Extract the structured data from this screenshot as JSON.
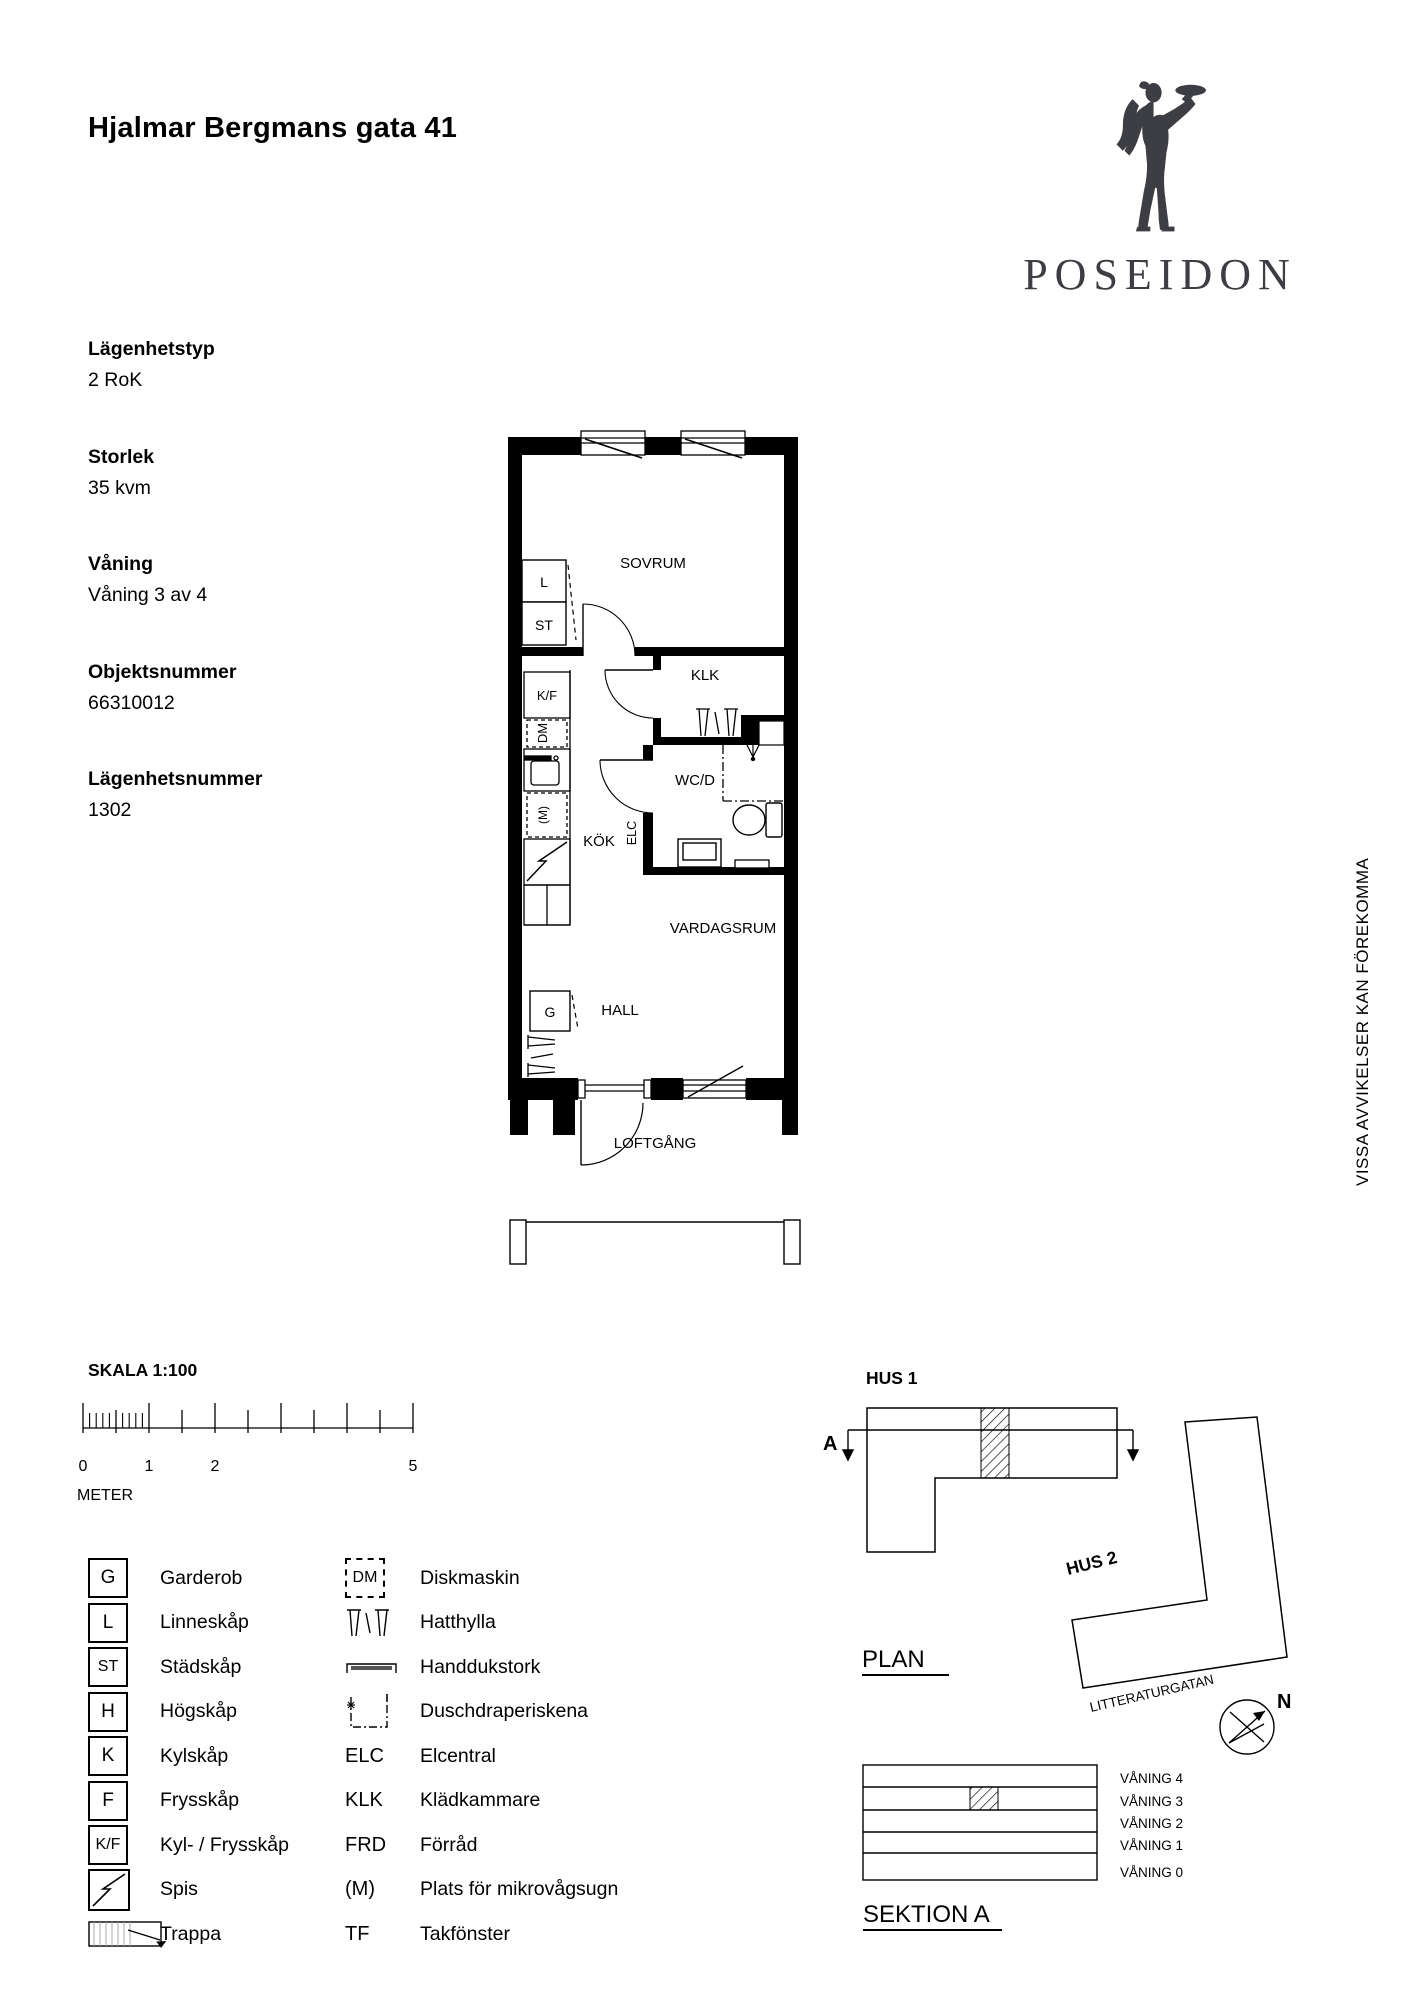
{
  "header": {
    "title": "Hjalmar Bergmans gata 41"
  },
  "logo": {
    "brand": "POSEIDON"
  },
  "info": {
    "fields": [
      {
        "label": "Lägenhetstyp",
        "value": "2 RoK"
      },
      {
        "label": "Storlek",
        "value": "35 kvm"
      },
      {
        "label": "Våning",
        "value": "Våning 3 av 4"
      },
      {
        "label": "Objektsnummer",
        "value": "66310012"
      },
      {
        "label": "Lägenhetsnummer",
        "value": "1302"
      }
    ]
  },
  "floorplan": {
    "rooms": {
      "sovrum": "SOVRUM",
      "klk": "KLK",
      "wcd": "WC/D",
      "kok": "KÖK",
      "vardagsrum": "VARDAGSRUM",
      "hall": "HALL",
      "loftgang": "LOFTGÅNG"
    },
    "markers": {
      "l": "L",
      "st": "ST",
      "kf": "K/F",
      "dm": "DM",
      "m": "(M)",
      "elc": "ELC",
      "g": "G"
    }
  },
  "disclaimer": "VISSA AVVIKELSER KAN FÖREKOMMA",
  "scalebar": {
    "title": "SKALA 1:100",
    "unit": "METER",
    "ticks": [
      "0",
      "1",
      "2",
      "5"
    ]
  },
  "legend": {
    "left": [
      {
        "code": "G",
        "label": "Garderob"
      },
      {
        "code": "L",
        "label": "Linneskåp"
      },
      {
        "code": "ST",
        "label": "Städskåp"
      },
      {
        "code": "H",
        "label": "Högskåp"
      },
      {
        "code": "K",
        "label": "Kylskåp"
      },
      {
        "code": "F",
        "label": "Frysskåp"
      },
      {
        "code": "K/F",
        "label": "Kyl- / Frysskåp"
      },
      {
        "code": "",
        "label": "Spis"
      },
      {
        "code": "",
        "label": "Trappa"
      }
    ],
    "right": [
      {
        "code": "DM",
        "label": "Diskmaskin"
      },
      {
        "code": "",
        "label": "Hatthylla"
      },
      {
        "code": "",
        "label": "Handdukstork"
      },
      {
        "code": "",
        "label": "Duschdraperiskena"
      },
      {
        "code": "ELC",
        "label": "Elcentral"
      },
      {
        "code": "KLK",
        "label": "Klädkammare"
      },
      {
        "code": "FRD",
        "label": "Förråd"
      },
      {
        "code": "(M)",
        "label": "Plats för mikrovågsugn"
      },
      {
        "code": "TF",
        "label": "Takfönster"
      }
    ]
  },
  "siteplan": {
    "hus1": "HUS 1",
    "hus2": "HUS 2",
    "plan_label": "PLAN",
    "street": "LITTERATURGATAN",
    "section_letter": "A",
    "north": "N"
  },
  "section": {
    "title": "SEKTION A",
    "floors": [
      "VÅNING 4",
      "VÅNING 3",
      "VÅNING 2",
      "VÅNING 1",
      "VÅNING 0"
    ]
  }
}
